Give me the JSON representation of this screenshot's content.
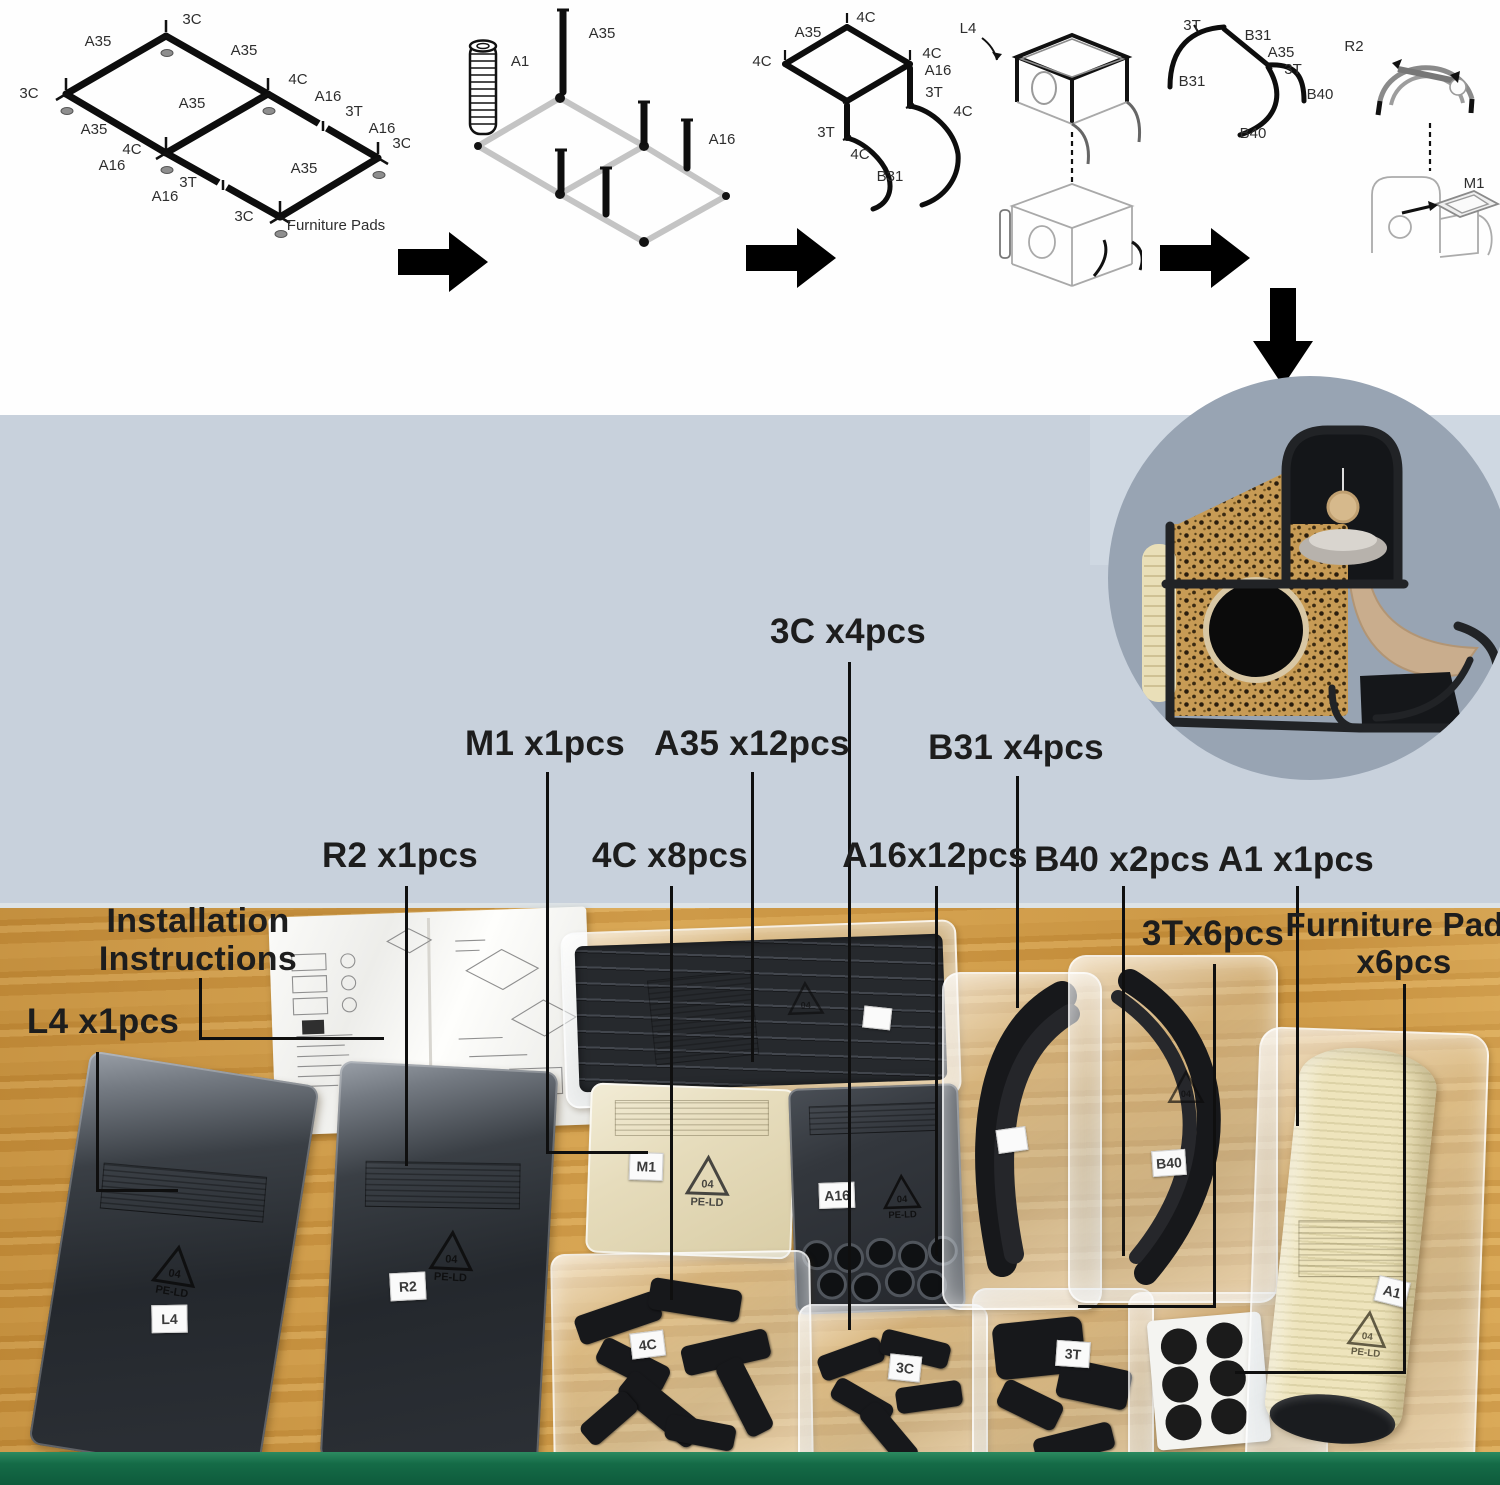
{
  "colors": {
    "band": "#c8d1dc",
    "circle_bg": "#98a4b3",
    "wood": "#cd9642",
    "green_edge": "#156b47",
    "label": "#1d1d1d",
    "leopard": "#c79b55",
    "sisal": "#e9dfb8"
  },
  "assembly_steps": {
    "s1": {
      "callouts": [
        {
          "t": "3C",
          "x": 186,
          "y": 18
        },
        {
          "t": "A35",
          "x": 92,
          "y": 40
        },
        {
          "t": "A35",
          "x": 238,
          "y": 49
        },
        {
          "t": "3C",
          "x": 23,
          "y": 92
        },
        {
          "t": "4C",
          "x": 292,
          "y": 78
        },
        {
          "t": "A16",
          "x": 322,
          "y": 95
        },
        {
          "t": "3T",
          "x": 348,
          "y": 110
        },
        {
          "t": "A16",
          "x": 376,
          "y": 127
        },
        {
          "t": "3C",
          "x": 396,
          "y": 142
        },
        {
          "t": "A35",
          "x": 186,
          "y": 102
        },
        {
          "t": "A35",
          "x": 88,
          "y": 128
        },
        {
          "t": "4C",
          "x": 126,
          "y": 148
        },
        {
          "t": "A16",
          "x": 106,
          "y": 164
        },
        {
          "t": "3T",
          "x": 182,
          "y": 181
        },
        {
          "t": "A16",
          "x": 159,
          "y": 195
        },
        {
          "t": "3C",
          "x": 238,
          "y": 215
        },
        {
          "t": "A35",
          "x": 298,
          "y": 167
        },
        {
          "t": "Furniture Pads",
          "x": 330,
          "y": 224
        }
      ]
    },
    "s2": {
      "callouts": [
        {
          "t": "A1",
          "x": 90,
          "y": 66
        },
        {
          "t": "A35",
          "x": 172,
          "y": 38
        },
        {
          "t": "A16",
          "x": 292,
          "y": 144
        }
      ]
    },
    "s3": {
      "callouts": [
        {
          "t": "4C",
          "x": 124,
          "y": 20
        },
        {
          "t": "A35",
          "x": 66,
          "y": 35
        },
        {
          "t": "4C",
          "x": 20,
          "y": 64
        },
        {
          "t": "4C",
          "x": 190,
          "y": 56
        },
        {
          "t": "A16",
          "x": 196,
          "y": 73
        },
        {
          "t": "3T",
          "x": 192,
          "y": 95
        },
        {
          "t": "4C",
          "x": 221,
          "y": 114
        },
        {
          "t": "3T",
          "x": 84,
          "y": 135
        },
        {
          "t": "4C",
          "x": 118,
          "y": 157
        },
        {
          "t": "B31",
          "x": 148,
          "y": 179
        },
        {
          "t": "L4",
          "x": 226,
          "y": 31
        }
      ]
    },
    "s4": {
      "callouts": [
        {
          "t": "3T",
          "x": 52,
          "y": 25
        },
        {
          "t": "B31",
          "x": 118,
          "y": 35
        },
        {
          "t": "A35",
          "x": 141,
          "y": 52
        },
        {
          "t": "3T",
          "x": 153,
          "y": 69
        },
        {
          "t": "B31",
          "x": 52,
          "y": 81
        },
        {
          "t": "B40",
          "x": 180,
          "y": 94
        },
        {
          "t": "B40",
          "x": 113,
          "y": 133
        },
        {
          "t": "R2",
          "x": 214,
          "y": 46
        },
        {
          "t": "M1",
          "x": 334,
          "y": 183
        }
      ]
    }
  },
  "part_labels": {
    "c3": "3C x4pcs",
    "m1": "M1 x1pcs",
    "a35": "A35 x12pcs",
    "b31": "B31 x4pcs",
    "r2": "R2 x1pcs",
    "c4": "4C x8pcs",
    "a16": "A16x12pcs",
    "b40": "B40 x2pcs",
    "a1": "A1 x1pcs",
    "t3": "3Tx6pcs",
    "fp_line1": "Furniture Pads",
    "fp_line2": "x6pcs",
    "inst_line1": "Installation",
    "inst_line2": "Instructions",
    "l4": "L4 x1pcs"
  },
  "stickers": {
    "l4": "L4",
    "r2": "R2",
    "m1": "M1",
    "a16": "A16",
    "c4": "4C",
    "c3": "3C",
    "t3": "3T",
    "b40": "B40",
    "a1": "A1"
  },
  "recycling": {
    "code": "04",
    "material": "PE-LD"
  },
  "instructions_page_number": "2"
}
